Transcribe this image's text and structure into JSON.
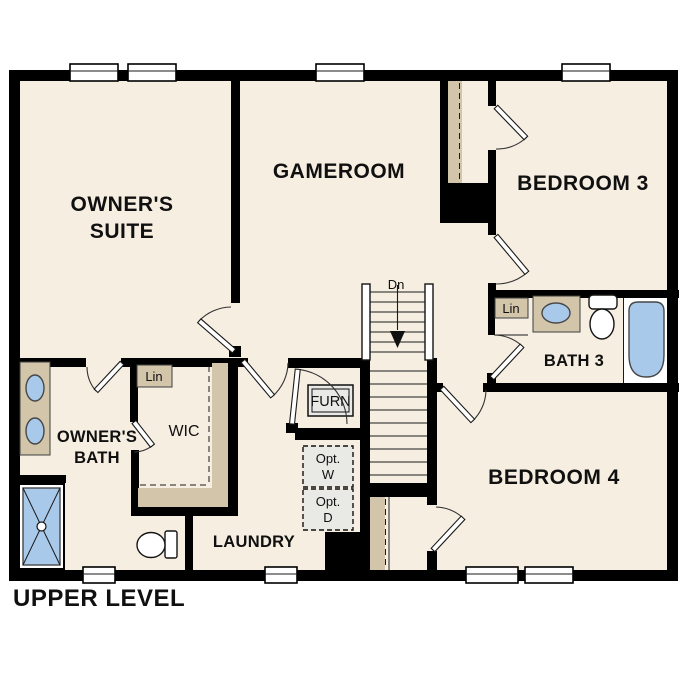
{
  "title": {
    "label": "UPPER LEVEL"
  },
  "rooms": {
    "owners_suite": {
      "line1": "OWNER'S",
      "line2": "SUITE"
    },
    "gameroom": {
      "label": "GAMEROOM"
    },
    "bedroom3": {
      "label": "BEDROOM 3"
    },
    "bath3": {
      "label": "BATH 3"
    },
    "bedroom4": {
      "label": "BEDROOM 4"
    },
    "owners_bath": {
      "line1": "OWNER'S",
      "line2": "BATH"
    },
    "wic": {
      "label": "WIC"
    },
    "laundry": {
      "label": "LAUNDRY"
    }
  },
  "closets": {
    "furnace": {
      "label": "FURN"
    },
    "linen_bath3": {
      "label": "Lin"
    },
    "linen_owners": {
      "label": "Lin"
    }
  },
  "optional_appliances": {
    "washer": {
      "line1": "Opt.",
      "line2": "W"
    },
    "dryer": {
      "line1": "Opt.",
      "line2": "D"
    }
  },
  "stairs": {
    "label": "Dn"
  },
  "colors": {
    "wall": "#000000",
    "floor": "#f6eee1",
    "cabinet": "#d2c5aa",
    "fixture": "#a9c9ea",
    "optional": "#e9e9e5"
  }
}
